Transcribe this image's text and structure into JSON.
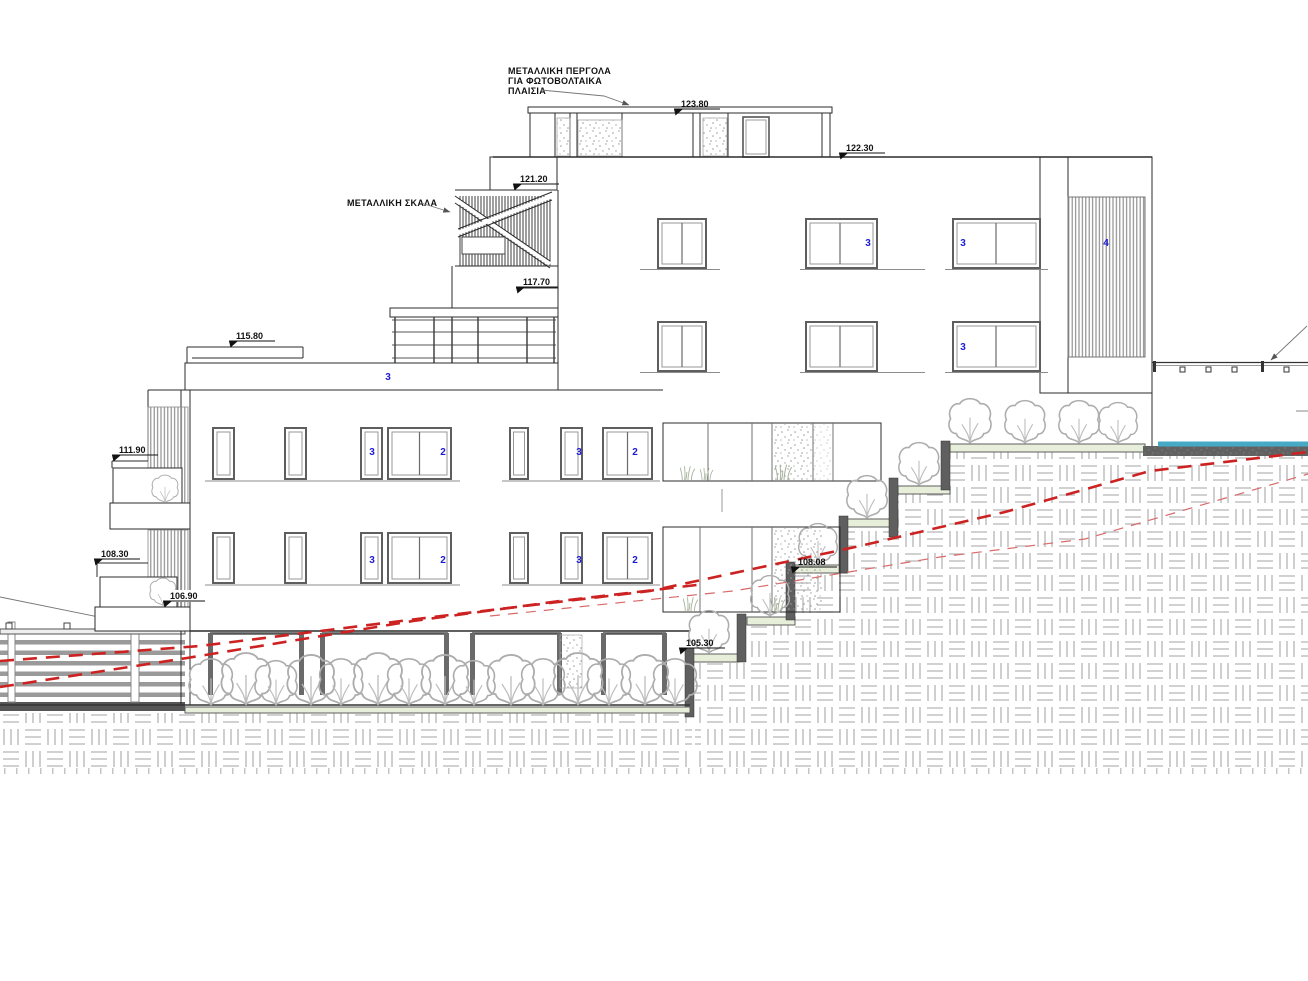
{
  "annotations": {
    "pergola_label_line1": "ΜΕΤΑΛΛΙΚΗ ΠΕΡΓΟΛΑ",
    "pergola_label_line2": "ΓΙΑ ΦΩΤΟΒΟΛΤΑΙΚΑ",
    "pergola_label_line3": "ΠΛΑΙΣΙΑ",
    "stair_label": "ΜΕΤΑΛΛΙΚΗ ΣΚΑΛΑ"
  },
  "levels": {
    "pergola": "123.80",
    "roof": "122.30",
    "stair_top": "121.20",
    "deck": "117.70",
    "low_roof": "115.80",
    "balcony_upper": "111.90",
    "balcony_lower": "108.30",
    "balcony_slab": "106.90",
    "terrace_step": "108.08",
    "garden_step": "105.30"
  },
  "window_tags": [
    "3",
    "3",
    "3",
    "4",
    "3",
    "3",
    "2",
    "3",
    "2",
    "3",
    "2",
    "3",
    "2"
  ],
  "colors": {
    "line": "#2b2b2b",
    "tag_blue": "#1b1bd6",
    "existing_ground_red": "#cc2222",
    "tread_green": "#e7efda",
    "retaining_wall": "#5f5f5f",
    "water": "#46aac6"
  }
}
